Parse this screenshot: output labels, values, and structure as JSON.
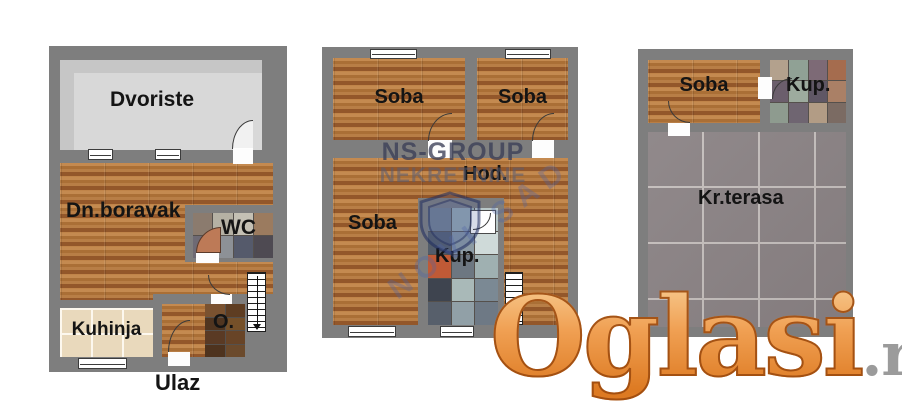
{
  "plans": {
    "ground_floor": {
      "courtyard_label": "Dvoriste",
      "living_room_label": "Dn.boravak",
      "wc_label": "WC",
      "kitchen_label": "Kuhinja",
      "storage_label": "O.",
      "entrance_label": "Ulaz"
    },
    "first_floor": {
      "room_top_left_label": "Soba",
      "room_top_right_label": "Soba",
      "hallway_label": "Hod.",
      "room_left_label": "Soba",
      "bathroom_label": "Kup."
    },
    "attic": {
      "room_label": "Soba",
      "bathroom_label": "Kup.",
      "terrace_label": "Kr.terasa"
    }
  },
  "watermarks": {
    "agency_name": "NS-GROUP",
    "agency_type": "NEKRETNINE",
    "agency_city": "NOVI SAD",
    "site_logo_text": "Oglasi",
    "site_logo_suffix": ".rs"
  },
  "colors": {
    "wall": "#7e7e7e",
    "wood_floor": "#ad7038",
    "courtyard_floor": "#c6c6c6",
    "kitchen_tile": "#e9d9bc",
    "terrace_tile": "#8b8385",
    "logo_orange": "#e8913f",
    "logo_gray": "#9b9b9b",
    "watermark_navy": "#3a3e56"
  }
}
